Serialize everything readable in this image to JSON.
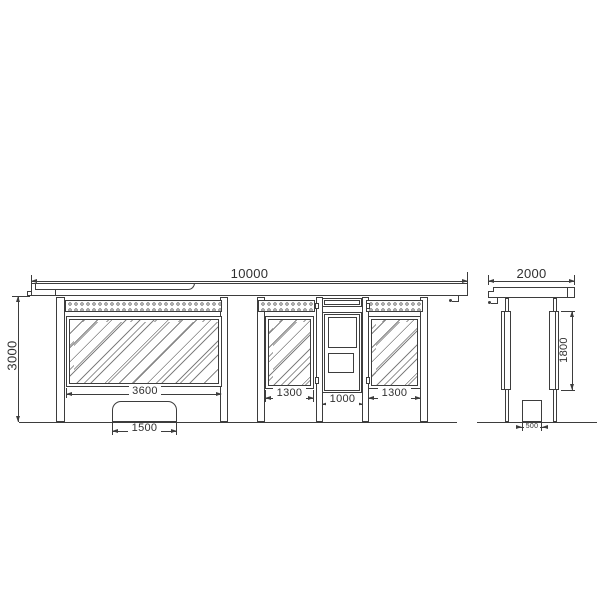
{
  "views": {
    "front": {
      "dims": {
        "overall_width": "10000",
        "overall_height": "3000",
        "main_window_width": "3600",
        "bench_width": "1500",
        "left_window_width": "1300",
        "door_width": "1000",
        "right_window_width": "1300"
      }
    },
    "side": {
      "dims": {
        "depth": "2000",
        "panel_height": "1800",
        "bench_depth": "500"
      }
    }
  },
  "colors": {
    "line": "#3d3d3d",
    "background": "#ffffff"
  }
}
